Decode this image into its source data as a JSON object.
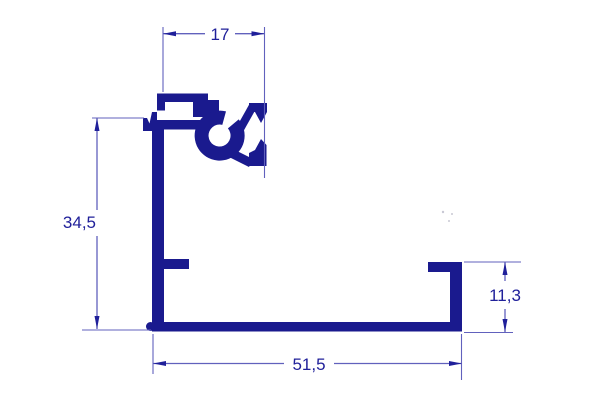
{
  "drawing": {
    "dimensions": {
      "top_width": "17",
      "left_height": "34,5",
      "bottom_width": "51,5",
      "right_height": "11,3"
    },
    "colors": {
      "profile": "#1a1a8e",
      "dimension_lines": "#6161bd",
      "dimension_text": "#20209a",
      "background": "#ffffff"
    }
  }
}
